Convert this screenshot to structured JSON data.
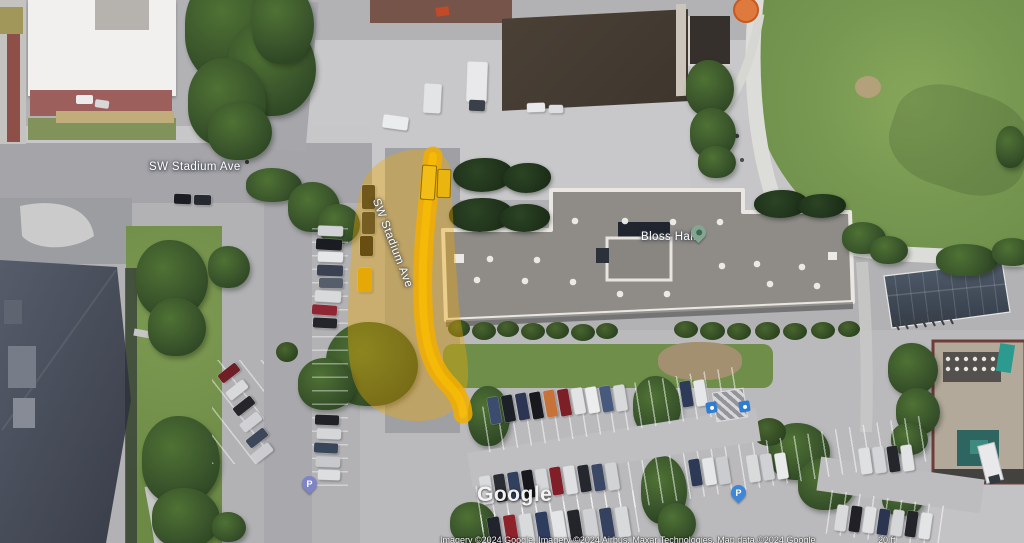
{
  "map": {
    "watermark": "Google",
    "attribution_line": "Imagery ©2024 Google, Imagery ©2024 Airbus, Maxar Technologies, Map data ©2024 Google",
    "scale_label": "20 ft",
    "labels": {
      "road_top": "SW Stadium Ave",
      "road_highlighted": "SW Stadium Ave",
      "building": "Bloss Hall"
    },
    "pins": {
      "parking_symbol": "P"
    },
    "highlight": {
      "fill": "#F0A800",
      "route": "#F2AE00",
      "route_core": "#FFC800"
    }
  }
}
